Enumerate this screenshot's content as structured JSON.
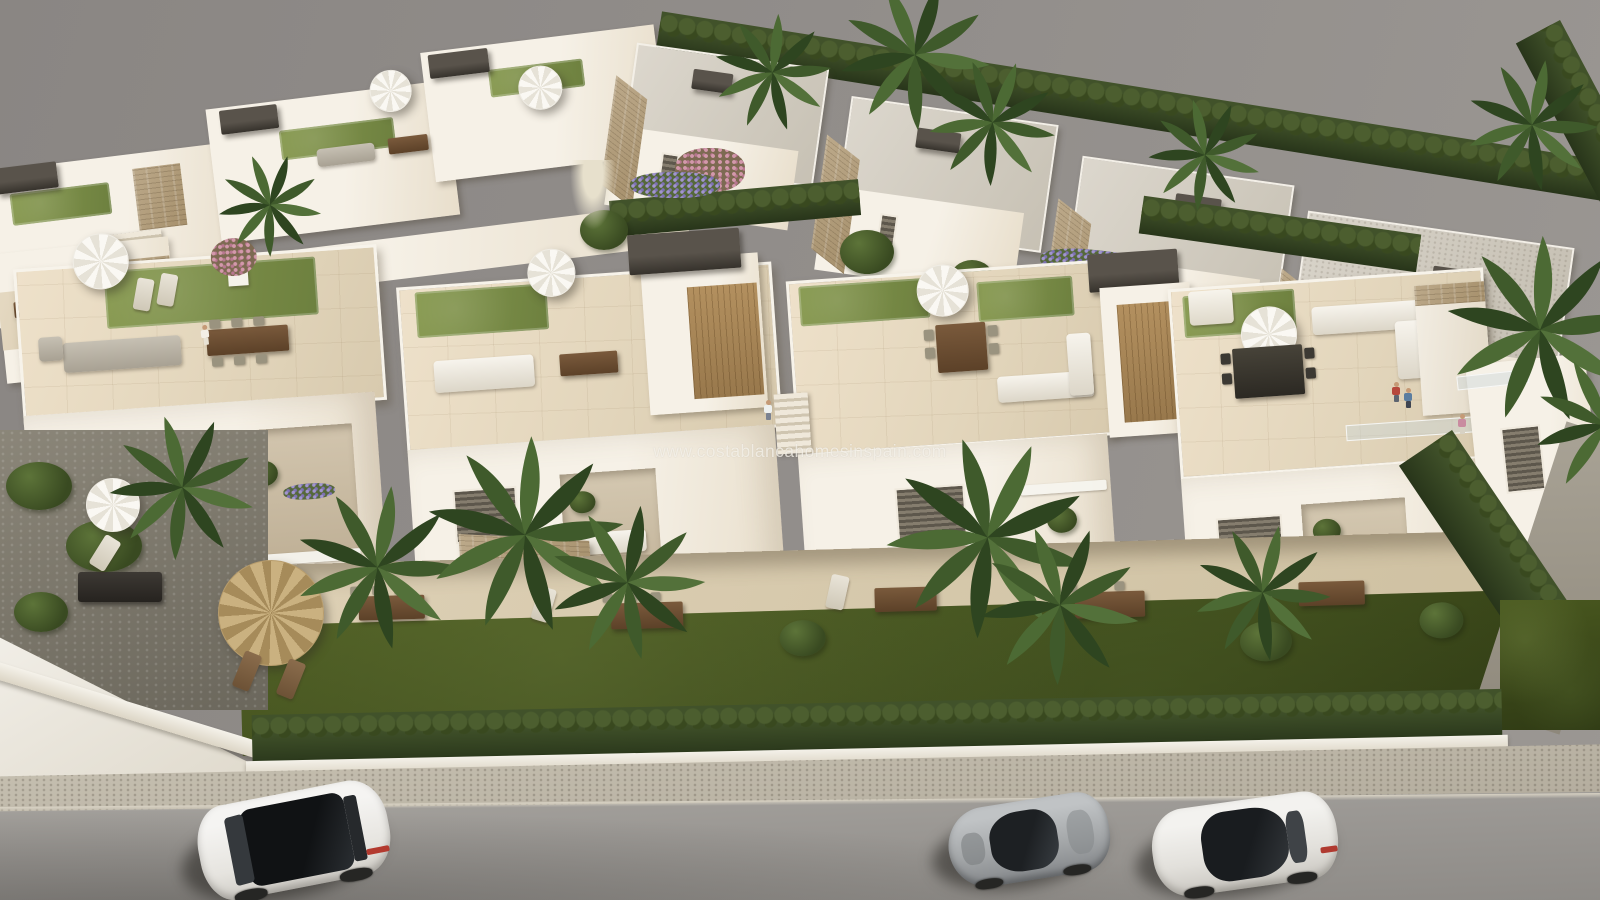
{
  "watermark": {
    "text": "www.costablancahomesinspain.com"
  },
  "scene": {
    "type": "aerial-3d-architectural-render",
    "subject": "New-build Mediterranean townhouse development with rooftop solariums, balconies, private gardens, cypress hedge, sidewalk and street with three parked cars",
    "palette": {
      "sky": "#908c89",
      "building_light": "#f6f1e7",
      "building_shade": "#d9cdb8",
      "roof_lawn": "#7b8e49",
      "garden_grass": "#3a4719",
      "hedge": "#3f5128",
      "stone_cladding": "#b2a07f",
      "pergola": "#45403a",
      "road": "#9c9995",
      "sidewalk": "#bdb6a7",
      "wood_slats": "#a8895c"
    },
    "vehicles": [
      {
        "label": "white SUV with black panoramic roof",
        "position": "left lane"
      },
      {
        "label": "silver sports coupe",
        "position": "center right"
      },
      {
        "label": "white sedan with dark glass roof",
        "position": "far right"
      }
    ],
    "figures": [
      {
        "label": "person walking on left rooftop solarium"
      },
      {
        "label": "couple standing at right rooftop railing"
      },
      {
        "label": "person near central roof stair"
      },
      {
        "label": "person on right balcony"
      }
    ]
  }
}
